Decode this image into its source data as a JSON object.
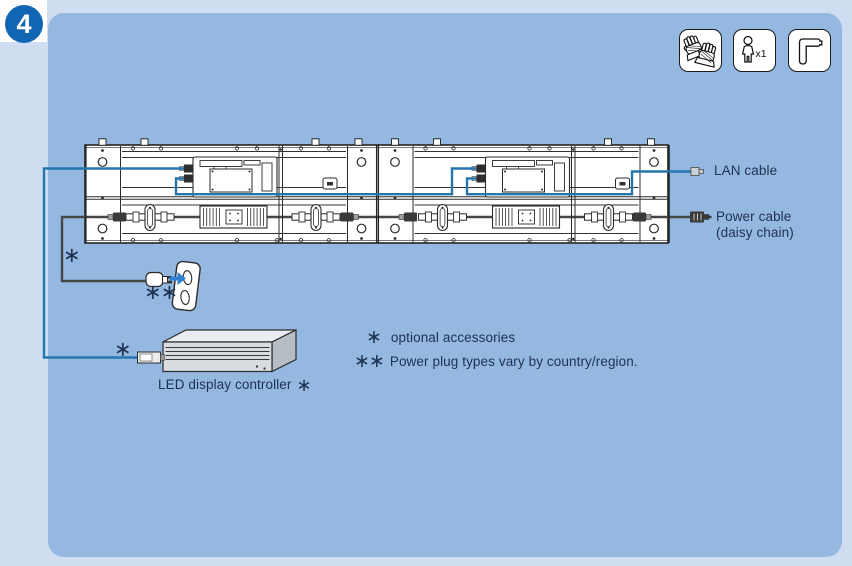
{
  "step_badge": "4",
  "theme": {
    "outer_bg": "#cfddf1",
    "panel_bg": "#95b8e1",
    "badge_bg": "#1166b3",
    "text_color": "#1d3150",
    "cable_blue": "#2576ac",
    "cable_gray": "#474747",
    "arrow_blue": "#2f80d0",
    "diagram_line": "#2b2b2b"
  },
  "safety_icons": [
    {
      "name": "gloves"
    },
    {
      "name": "one-person",
      "label": "x1"
    },
    {
      "name": "hex-key"
    }
  ],
  "callouts": {
    "lan_cable": "LAN cable",
    "power_cable_line1": "Power cable",
    "power_cable_line2": "(daisy chain)",
    "controller_label": "LED display controller",
    "controller_marker": "∗"
  },
  "markers": {
    "cable_bend": "∗",
    "plug": "∗∗",
    "controller_cable": "∗"
  },
  "notes": [
    {
      "marker": "∗",
      "text": "optional accessories"
    },
    {
      "marker": "∗∗",
      "text": "Power plug types vary by country/region."
    }
  ]
}
